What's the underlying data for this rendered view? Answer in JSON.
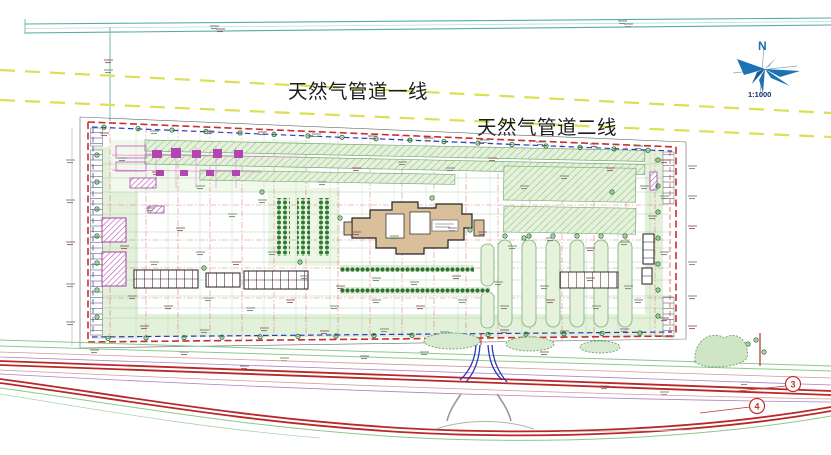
{
  "drawing": {
    "pipeline1_label": "天然气管道一线",
    "pipeline2_label": "天然气管道二线",
    "compass": {
      "north_label": "N",
      "scale_label": "1:1000"
    },
    "road_markers": {
      "marker_a": "3",
      "marker_b": "4"
    },
    "colors": {
      "boundary_red": "#c43030",
      "site_blue": "#2a3ac0",
      "pipeline_yellow": "#dede52",
      "road_red": "#b82828",
      "vegetation_green": "#6fae6f",
      "magenta": "#b444b4",
      "compass_blue": "#1b72b4",
      "building_tan": "#d9c09b"
    }
  }
}
